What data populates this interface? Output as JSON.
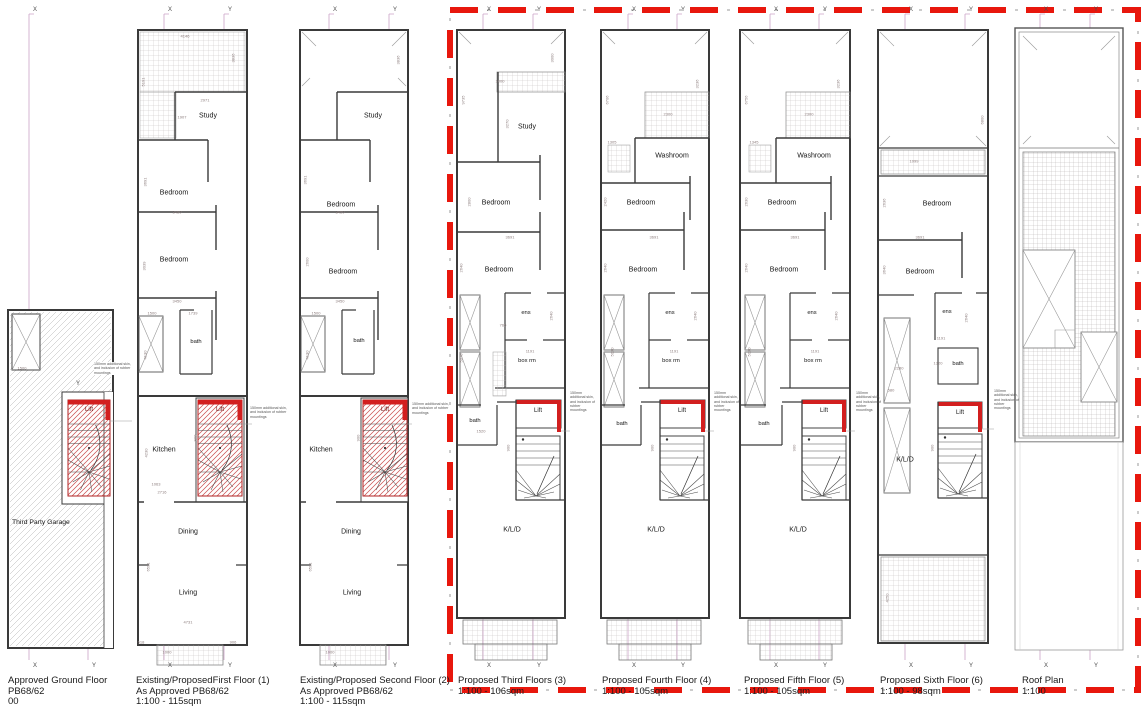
{
  "axis_labels": {
    "x": "X",
    "y": "Y"
  },
  "note_text": "150mm additional skin, and inclusion of rubber mountings",
  "colors": {
    "lift_red": "#d21f1f",
    "boundary_red": "#e8170d",
    "grid_line_pink": "#cba4c8",
    "wall": "#3a3a3a"
  },
  "plans": [
    {
      "key": "ground",
      "caption": [
        "Approved Ground Floor",
        "PB68/62",
        "00"
      ],
      "rooms": {
        "garage": "Third Party Garage",
        "lift": "Lift"
      },
      "dims": [
        "1500"
      ]
    },
    {
      "key": "first",
      "caption": [
        "Existing/ProposedFirst Floor (1)",
        "As Approved PB68/62",
        "1:100 - 115sqm"
      ],
      "rooms": {
        "study": "Study",
        "bedroom_a": "Bedroom",
        "bedroom_b": "Bedroom",
        "bath": "bath",
        "lift": "Lift",
        "kitchen": "Kitchen",
        "dining": "Dining",
        "living": "Living"
      },
      "dims": [
        "4146",
        "3836",
        "5191",
        "2971",
        "1907",
        "3691",
        "3450",
        "3039",
        "3450",
        "1500",
        "1739",
        "4130",
        "900",
        "4230",
        "1063",
        "2716",
        "6591",
        "4731",
        "618",
        "1000",
        "906"
      ]
    },
    {
      "key": "second",
      "caption": [
        "Existing/Proposed Second Floor (2)",
        "As Approved PB68/62",
        "1:100 - 115sqm"
      ],
      "rooms": {
        "study": "Study",
        "bedroom_a": "Bedroom",
        "bedroom_b": "Bedroom",
        "bath": "bath",
        "lift": "Lift",
        "kitchen": "Kitchen",
        "dining": "Dining",
        "living": "Living"
      },
      "dims": [
        "3836",
        "3691",
        "3450",
        "2600",
        "3450",
        "1500",
        "4130",
        "900",
        "6591",
        "1000"
      ]
    },
    {
      "key": "third",
      "caption": [
        "Proposed Third Floors (3)",
        "1:100 - 106sqm"
      ],
      "rooms": {
        "study": "Study",
        "bedroom_a": "Bedroom",
        "bedroom_b": "Bedroom",
        "ens": "ens",
        "box_rm": "box rm",
        "bath": "bath",
        "lift": "Lift",
        "kld": "K/L/D"
      },
      "dims": [
        "9735",
        "3000",
        "1000",
        "3270",
        "2800",
        "3691",
        "2640",
        "2640",
        "1191",
        "760",
        "1520",
        "5070",
        "900"
      ]
    },
    {
      "key": "fourth",
      "caption": [
        "Proposed Fourth Floor (4)",
        "1:100 - 105sqm"
      ],
      "rooms": {
        "washroom": "Washroom",
        "bedroom_a": "Bedroom",
        "bedroom_b": "Bedroom",
        "ens": "ens",
        "box_rm": "box rm",
        "bath": "bath",
        "lift": "Lift",
        "kld": "K/L/D"
      },
      "dims": [
        "6706",
        "3236",
        "2300",
        "1305",
        "2420",
        "3691",
        "2640",
        "2640",
        "1191",
        "5070",
        "900"
      ]
    },
    {
      "key": "fifth",
      "caption": [
        "Proposed Fifth Floor (5)",
        "1:100 - 105sqm"
      ],
      "rooms": {
        "washroom": "Washroom",
        "bedroom_a": "Bedroom",
        "bedroom_b": "Bedroom",
        "ens": "ens",
        "box_rm": "box rm",
        "bath": "bath",
        "lift": "Lift",
        "kld": "K/L/D"
      },
      "dims": [
        "6756",
        "3236",
        "2300",
        "1345",
        "2630",
        "3691",
        "2640",
        "2640",
        "1191",
        "5070",
        "900"
      ]
    },
    {
      "key": "sixth",
      "caption": [
        "Proposed Sixth Floor (6)",
        "1:100 - 98sqm"
      ],
      "rooms": {
        "bedroom_a": "Bedroom",
        "bedroom_b": "Bedroom",
        "ens": "ens",
        "bath": "bath",
        "lift": "Lift",
        "kld": "K/L/D"
      },
      "dims": [
        "6800",
        "1099",
        "2636",
        "3691",
        "3640",
        "2640",
        "1191",
        "2280",
        "580",
        "1320",
        "900",
        "4250"
      ]
    },
    {
      "key": "roof",
      "caption": [
        "Roof Plan",
        "1:100"
      ],
      "rooms": {},
      "dims": []
    }
  ]
}
